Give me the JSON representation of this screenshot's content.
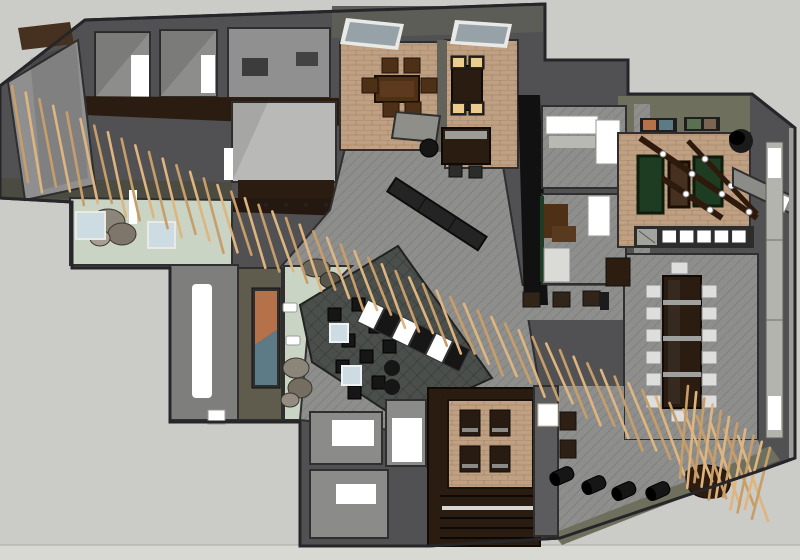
{
  "title": "3D rendered interior floor plan — top-down view",
  "scene": {
    "type": "3d-floorplan-render",
    "description": "Top-down 3D architectural rendering of an office/hospitality interior: diagonal wood-slat screen, dining rooms, bar, game room with green tables, conference room, dark lounge, restrooms and stairs.",
    "features": {
      "slats_main_count": 54,
      "slats_corner_count": 11,
      "conference_chairs_side_count": 6,
      "lounge_stool_count": 9,
      "display_case_count": 6,
      "gameroom_window_count": 5,
      "pouf_count": 5,
      "beam_light_count": 8,
      "dining_chair_count": 6,
      "lit_chair_count": 4,
      "booth_chair_count": 4,
      "office_stool_count": 3
    }
  },
  "palette": {
    "exterior": "#cbcbc7",
    "exterior_light": "#d9d9d4",
    "wall_mid": "#515153",
    "wall_dark": "#3a3a3c",
    "wall_black": "#111111",
    "outline": "#262628",
    "olive_band": "#6f6f5e",
    "olive_dark": "#4b4b41",
    "feature_wall": "#5f5c4d",
    "floor_gray": "#8d8d8b",
    "floor_light": "#b9b9b7",
    "carpet_gray": "#8e8f8c",
    "carpet_line": "#7c7d7a",
    "lounge_floor": "#4b4f4c",
    "mint_floor": "#c9d4c4",
    "floor_tan": "#bfa083",
    "brick_line": "#a1846a",
    "wood_dark": "#2a1c11",
    "wood_brown": "#46301f",
    "wood_red": "#4e3017",
    "slat_tan": "#dfb57f",
    "slat_shadow": "#c79e69",
    "green_table": "#1e3c22",
    "white_glow": "#ffffff",
    "blue_table": "#cddbe2",
    "chair_white": "#dedede",
    "black_furniture": "#161616",
    "charcoal": "#242424",
    "skylight": "#97a2a8",
    "art_orange": "#b5714a",
    "art_blue": "#5d7a87",
    "stone": "#8c867a",
    "seat_lit": "#edcb8e",
    "metal": "#9fa0a0",
    "window_strip": "#b4b4ae"
  }
}
